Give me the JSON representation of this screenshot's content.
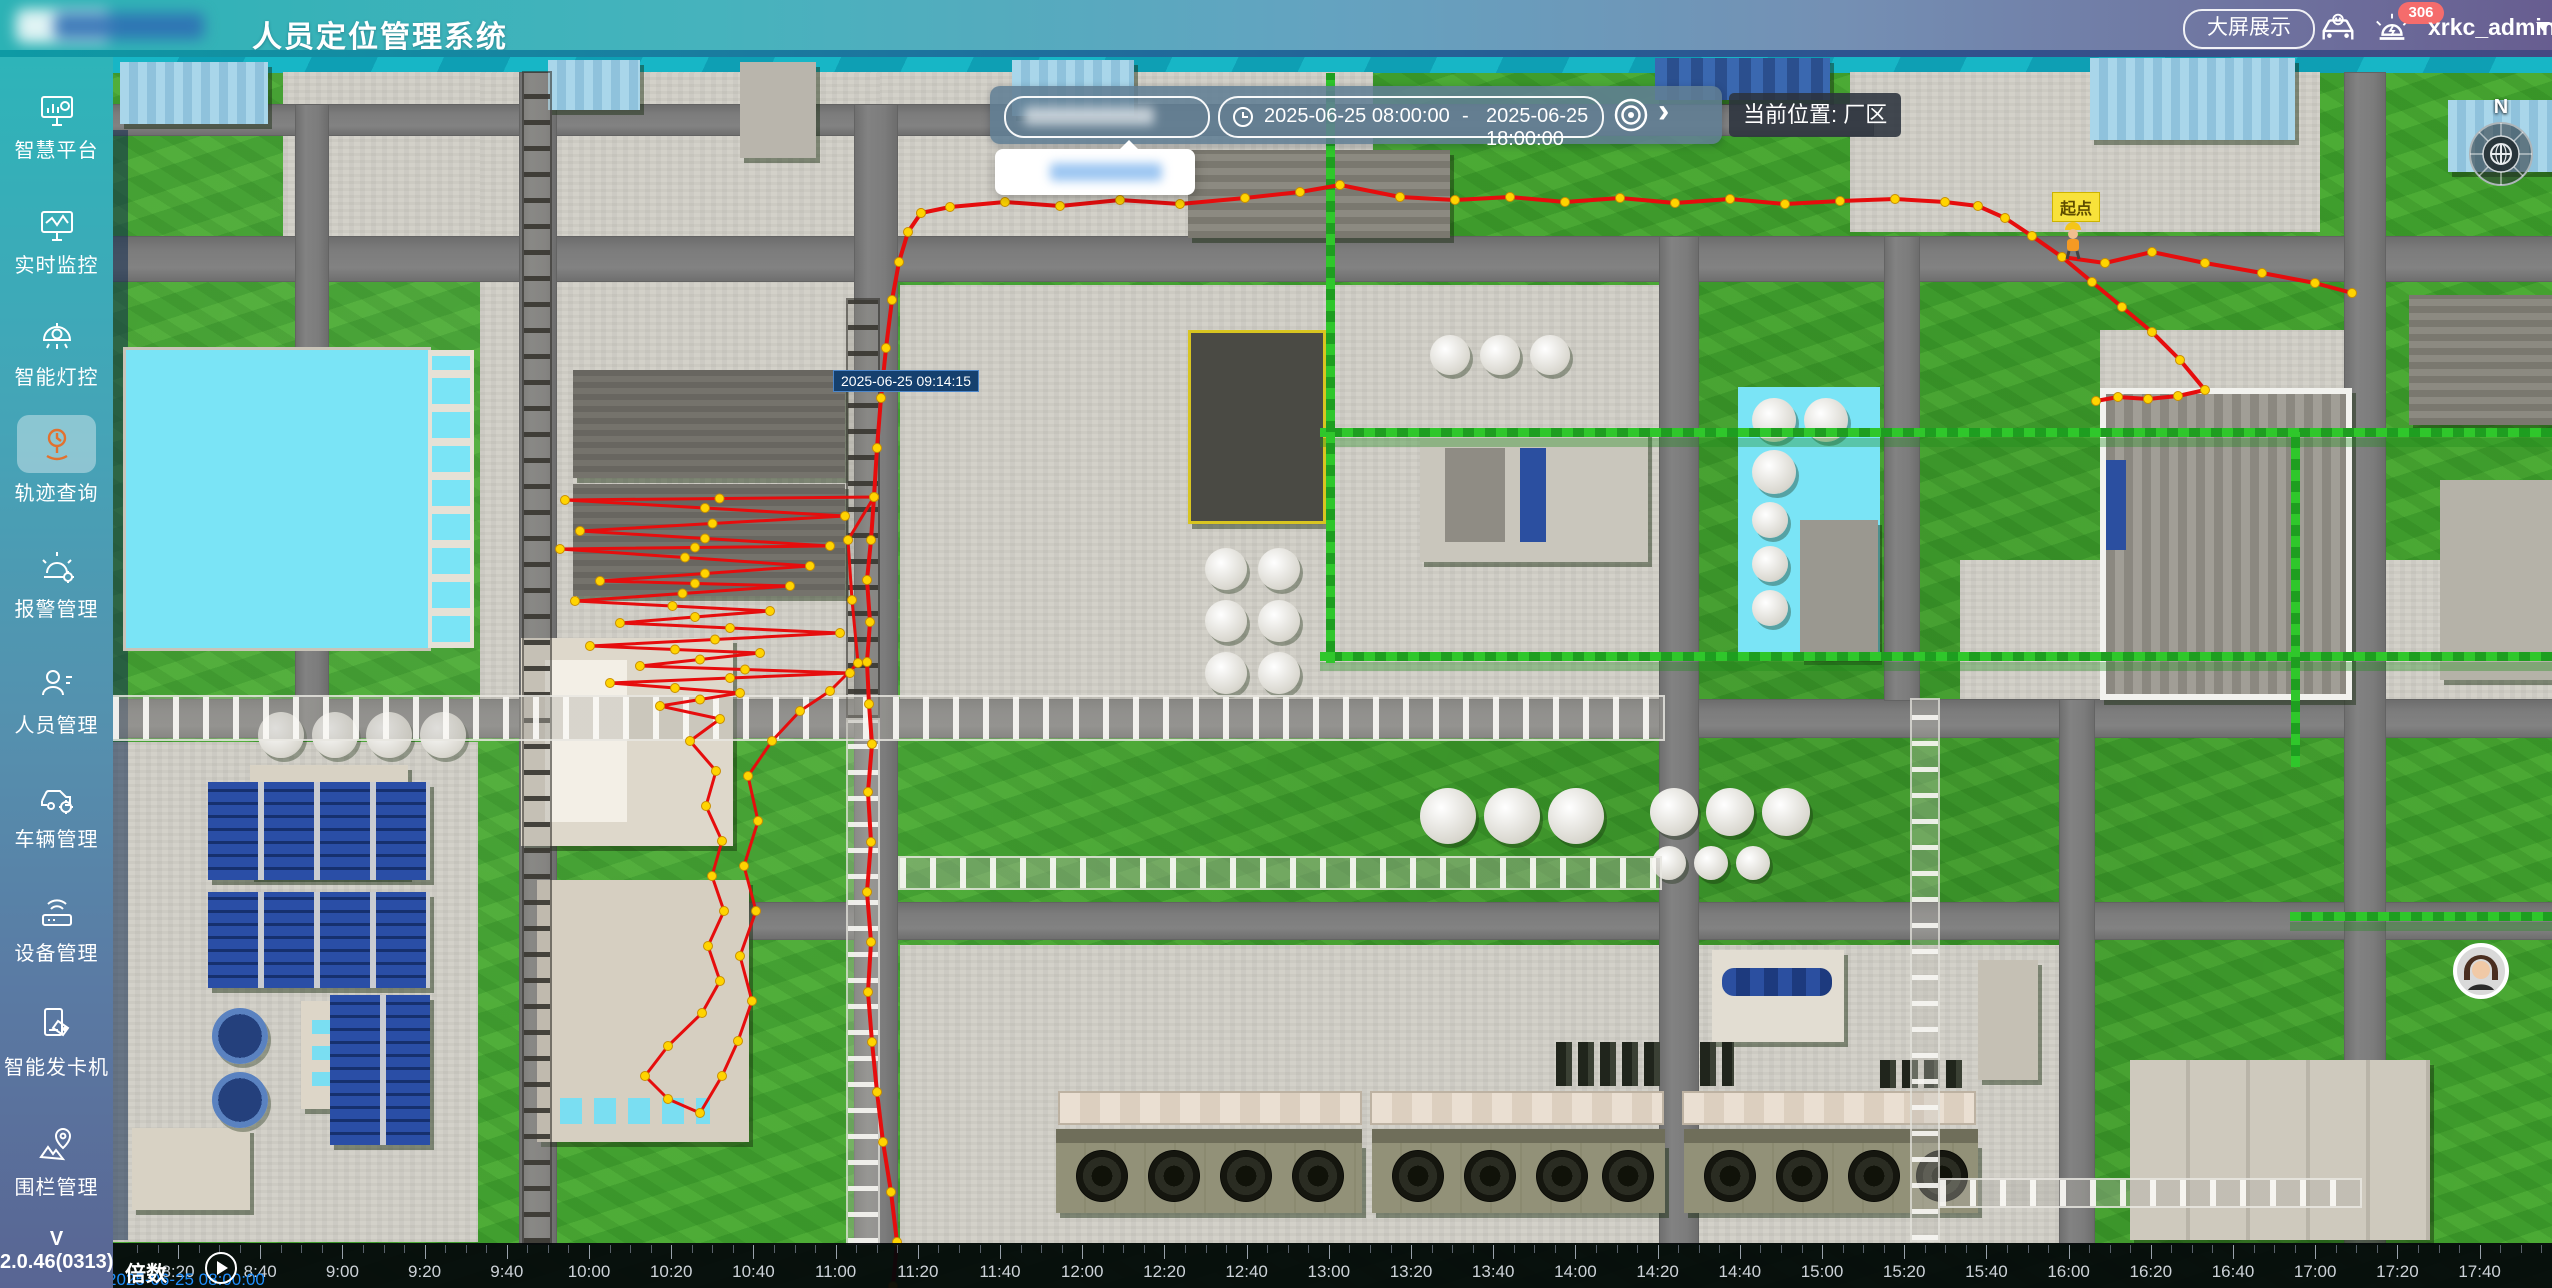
{
  "header": {
    "title": "人员定位管理系统",
    "big_screen": "大屏展示",
    "alarm_badge": "306",
    "username": "xrkc_admin"
  },
  "sidebar": {
    "items": [
      {
        "label": "智慧平台"
      },
      {
        "label": "实时监控"
      },
      {
        "label": "智能灯控"
      },
      {
        "label": "轨迹查询",
        "active": true
      },
      {
        "label": "报警管理"
      },
      {
        "label": "人员管理"
      },
      {
        "label": "车辆管理"
      },
      {
        "label": "设备管理"
      },
      {
        "label": "智能发卡机"
      },
      {
        "label": "围栏管理"
      }
    ],
    "version": "V 2.0.46(0313)"
  },
  "controls": {
    "date_start": "2025-06-25 08:00:00",
    "date_sep": "-",
    "date_end": "2025-06-25 18:00:00",
    "location": "当前位置: 厂区"
  },
  "map": {
    "tooltip": "2025-06-25 09:14:15",
    "start_label": "起点",
    "compass_n": "N"
  },
  "timeline": {
    "speed_label": "倍数",
    "current_datetime": "2025-06-25 08:00:00",
    "first_label_x": 65,
    "spacing": 82.2,
    "labels": [
      "8:20",
      "8:40",
      "9:00",
      "9:20",
      "9:40",
      "10:00",
      "10:20",
      "10:40",
      "11:00",
      "11:20",
      "11:40",
      "12:00",
      "12:20",
      "12:40",
      "13:00",
      "13:20",
      "13:40",
      "14:00",
      "14:20",
      "14:40",
      "15:00",
      "15:20",
      "15:40",
      "16:00",
      "16:20",
      "16:40",
      "17:00",
      "17:20",
      "17:40"
    ]
  },
  "trajectory": {
    "stroke": "#e60d0d",
    "dot_color": "#ffd400",
    "dot_edge": "#c98f00",
    "polylines": [
      [
        [
          921,
          213
        ],
        [
          950,
          207
        ],
        [
          1005,
          202
        ],
        [
          1060,
          206
        ],
        [
          1120,
          200
        ],
        [
          1180,
          204
        ],
        [
          1245,
          198
        ],
        [
          1300,
          192
        ],
        [
          1340,
          185
        ],
        [
          1400,
          197
        ],
        [
          1455,
          200
        ],
        [
          1510,
          197
        ],
        [
          1565,
          202
        ],
        [
          1620,
          198
        ],
        [
          1675,
          203
        ],
        [
          1730,
          199
        ],
        [
          1785,
          204
        ],
        [
          1840,
          201
        ],
        [
          1895,
          199
        ],
        [
          1945,
          202
        ],
        [
          1978,
          206
        ],
        [
          2005,
          218
        ],
        [
          2032,
          236
        ],
        [
          2062,
          257
        ],
        [
          2092,
          282
        ],
        [
          2122,
          307
        ],
        [
          2152,
          332
        ],
        [
          2180,
          360
        ],
        [
          2205,
          390
        ],
        [
          2178,
          396
        ],
        [
          2148,
          399
        ],
        [
          2118,
          397
        ],
        [
          2096,
          401
        ]
      ],
      [
        [
          2062,
          257
        ],
        [
          2105,
          263
        ],
        [
          2152,
          252
        ],
        [
          2205,
          263
        ],
        [
          2262,
          273
        ],
        [
          2315,
          283
        ],
        [
          2352,
          293
        ]
      ],
      [
        [
          921,
          213
        ],
        [
          908,
          232
        ],
        [
          899,
          262
        ],
        [
          892,
          300
        ],
        [
          886,
          348
        ],
        [
          881,
          398
        ],
        [
          877,
          448
        ],
        [
          874,
          497
        ]
      ],
      [
        [
          874,
          497
        ],
        [
          871,
          540
        ],
        [
          867,
          580
        ],
        [
          870,
          622
        ],
        [
          867,
          662
        ],
        [
          869,
          704
        ],
        [
          872,
          744
        ],
        [
          868,
          792
        ],
        [
          871,
          842
        ],
        [
          867,
          892
        ],
        [
          871,
          942
        ],
        [
          868,
          992
        ],
        [
          872,
          1042
        ],
        [
          877,
          1092
        ],
        [
          883,
          1142
        ],
        [
          891,
          1192
        ],
        [
          897,
          1242
        ],
        [
          893,
          1286
        ]
      ],
      [
        [
          874,
          497
        ],
        [
          565,
          500
        ],
        [
          845,
          516
        ],
        [
          580,
          531
        ],
        [
          830,
          546
        ],
        [
          560,
          549
        ],
        [
          810,
          566
        ],
        [
          600,
          581
        ],
        [
          790,
          586
        ],
        [
          575,
          601
        ],
        [
          770,
          611
        ],
        [
          620,
          623
        ],
        [
          840,
          633
        ],
        [
          590,
          646
        ],
        [
          760,
          653
        ],
        [
          640,
          666
        ],
        [
          850,
          673
        ],
        [
          610,
          683
        ],
        [
          740,
          693
        ],
        [
          660,
          706
        ],
        [
          720,
          719
        ],
        [
          690,
          741
        ],
        [
          716,
          771
        ],
        [
          706,
          806
        ],
        [
          722,
          841
        ],
        [
          712,
          876
        ],
        [
          724,
          911
        ],
        [
          708,
          946
        ],
        [
          720,
          981
        ],
        [
          702,
          1013
        ],
        [
          668,
          1046
        ],
        [
          645,
          1076
        ],
        [
          668,
          1099
        ],
        [
          700,
          1113
        ],
        [
          722,
          1076
        ],
        [
          738,
          1041
        ],
        [
          752,
          1001
        ],
        [
          740,
          956
        ],
        [
          756,
          911
        ],
        [
          744,
          866
        ],
        [
          758,
          821
        ],
        [
          748,
          776
        ],
        [
          772,
          741
        ],
        [
          800,
          711
        ],
        [
          830,
          691
        ],
        [
          858,
          663
        ],
        [
          852,
          600
        ],
        [
          848,
          540
        ],
        [
          874,
          497
        ]
      ]
    ]
  }
}
